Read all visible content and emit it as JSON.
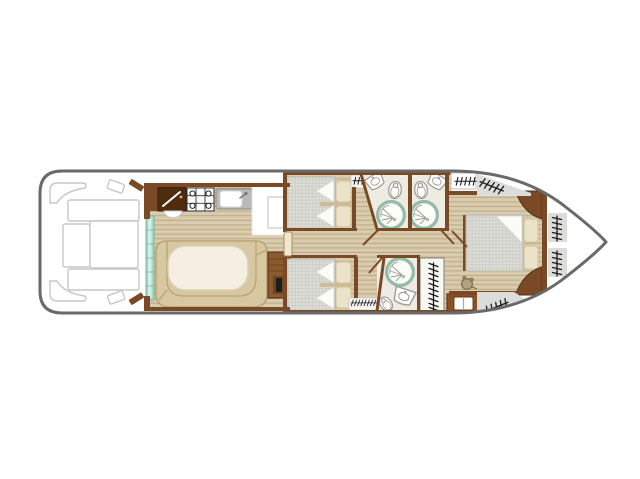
{
  "colors": {
    "hull": "#6a6a6a",
    "wall": "#7a4a26",
    "cabinetDark": "#4e2c10",
    "woodBase": "#d9cbad",
    "woodLine": "#bca983",
    "mat": "#dededa",
    "matLine": "#cbcbc3",
    "bench": "#d8c8a2",
    "benchEdge": "#b59c6e",
    "table": "#f4efe1",
    "tableEdge": "#d9cfb4",
    "pillow": "#ebe3c9",
    "pillowEdge": "#cfc09c",
    "teal": "#a9dac9",
    "tealEdge": "#6fb59e",
    "bathFloor": "#edebe2",
    "deckGray": "#dcdcda",
    "ink": "#1c1c1c",
    "outline": "#c7c7c7",
    "fixture": "#9b9b93",
    "showerRing": "#8cc0ad",
    "chest": "#8a4f22",
    "chestDark": "#5f3a1c"
  },
  "boat_plan": {
    "orientation": {
      "stern": "left",
      "bow": "right"
    },
    "stern_deck": {
      "items": [
        "corner-seat",
        "corner-seat",
        "deck-bench",
        "deck-bench",
        "deck-locker",
        "deck-locker",
        "deck-step",
        "deck-step",
        "deck-door",
        "deck-door"
      ]
    },
    "galley": {
      "items": [
        "utensil-cabinet",
        "round-sink",
        "stove-4-burner",
        "kitchen-sink",
        "counter",
        "fridge"
      ]
    },
    "saloon": {
      "items": [
        "sliding-door",
        "u-bench",
        "oval-table",
        "companionway-steps"
      ]
    },
    "corridor": {
      "items": [
        "door"
      ]
    },
    "cabin_mid_top": {
      "items": [
        "twin-beds",
        "pillow",
        "pillow",
        "hanging-locker"
      ]
    },
    "cabin_mid_bottom": {
      "items": [
        "twin-beds",
        "pillow",
        "pillow",
        "hanging-locker"
      ]
    },
    "bathroom_top_left": {
      "items": [
        "shower",
        "toilet",
        "washbasin"
      ]
    },
    "bathroom_top_right": {
      "items": [
        "shower",
        "toilet",
        "washbasin"
      ]
    },
    "bathroom_bottom": {
      "items": [
        "shower",
        "toilet",
        "washbasin"
      ]
    },
    "wardrobe": {
      "items": [
        "hanger-rail"
      ]
    },
    "study_corner": {
      "items": [
        "stool",
        "chest"
      ]
    },
    "bow_cabin": {
      "items": [
        "double-bed",
        "pillow",
        "pillow",
        "corner-cabinet",
        "corner-cabinet",
        "headboard-wall"
      ]
    },
    "bow_deck": {
      "items": [
        "ladder",
        "ladder",
        "boarding-step",
        "boarding-step",
        "deck-steps",
        "deck-steps"
      ]
    }
  }
}
